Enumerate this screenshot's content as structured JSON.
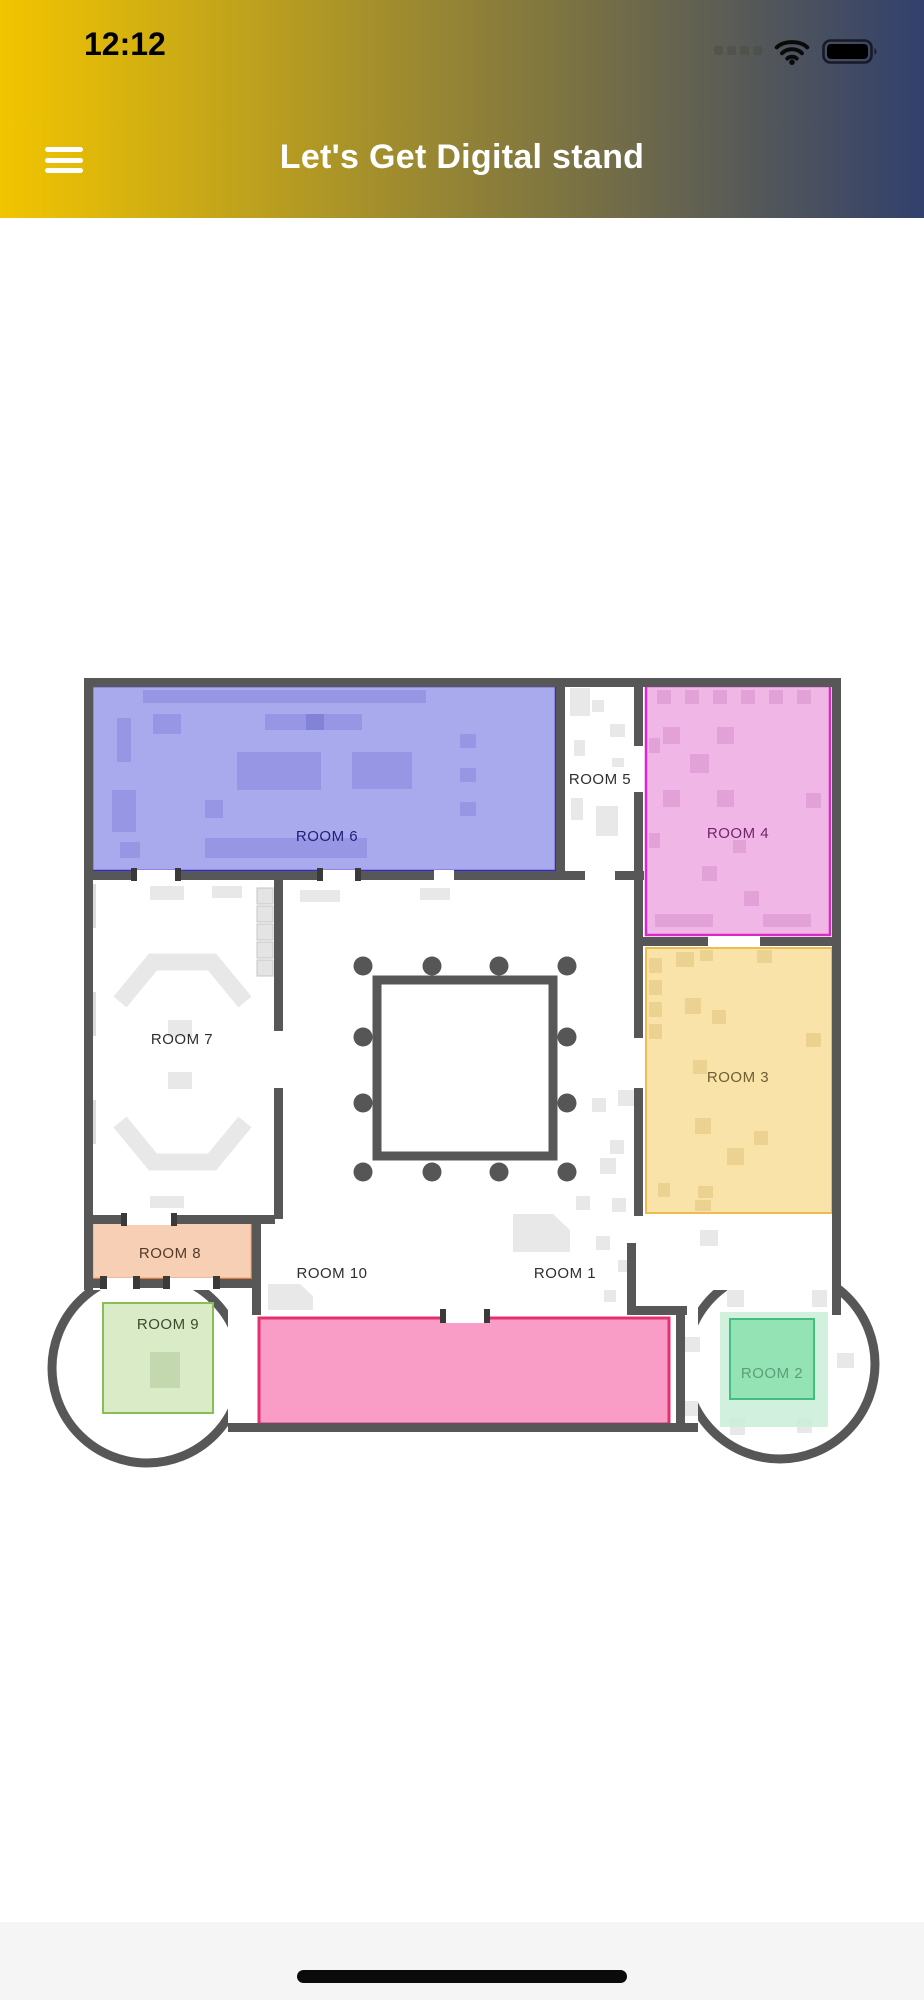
{
  "status_bar": {
    "time": "12:12"
  },
  "header": {
    "title": "Let's Get Digital stand",
    "gradient_start": "#F2C500",
    "gradient_end": "#32406C",
    "text_color": "#FFFFFF"
  },
  "floor_plan": {
    "wall_color": "#575757",
    "floor_color": "#FFFFFF",
    "rooms": {
      "room1": {
        "label": "ROOM 1",
        "label_color": "#2E2E2E"
      },
      "room2": {
        "label": "ROOM 2",
        "fill": "#93E3B5",
        "outer_fill": "#C9EFD8",
        "stroke": "#43BE7C",
        "label_color": "#5D9E7A"
      },
      "room3": {
        "label": "ROOM 3",
        "fill": "#F9E3A9",
        "stroke": "#EEBB4D",
        "label_color": "#6E5E33"
      },
      "room4": {
        "label": "ROOM 4",
        "fill": "#EFB6E6",
        "stroke": "#DB29C9",
        "label_color": "#73256B"
      },
      "room5": {
        "label": "ROOM 5",
        "label_color": "#2E2E2E"
      },
      "room6": {
        "label": "ROOM 6",
        "fill": "#A9A9EE",
        "stroke": "#2D2DCE",
        "label_color": "#20207A"
      },
      "room7": {
        "label": "ROOM 7",
        "label_color": "#2E2E2E"
      },
      "room8": {
        "label": "ROOM 8",
        "fill": "#F6CFB5",
        "stroke": "#DE7A36",
        "label_color": "#553A28"
      },
      "room9": {
        "label": "ROOM 9",
        "fill": "#DAEBC7",
        "stroke": "#8ABD57",
        "label_color": "#3C4A2F"
      },
      "room10": {
        "label": "ROOM 10",
        "label_color": "#2E2E2E"
      },
      "hall": {
        "fill": "#F99DC7",
        "stroke": "#E72F70"
      }
    }
  }
}
